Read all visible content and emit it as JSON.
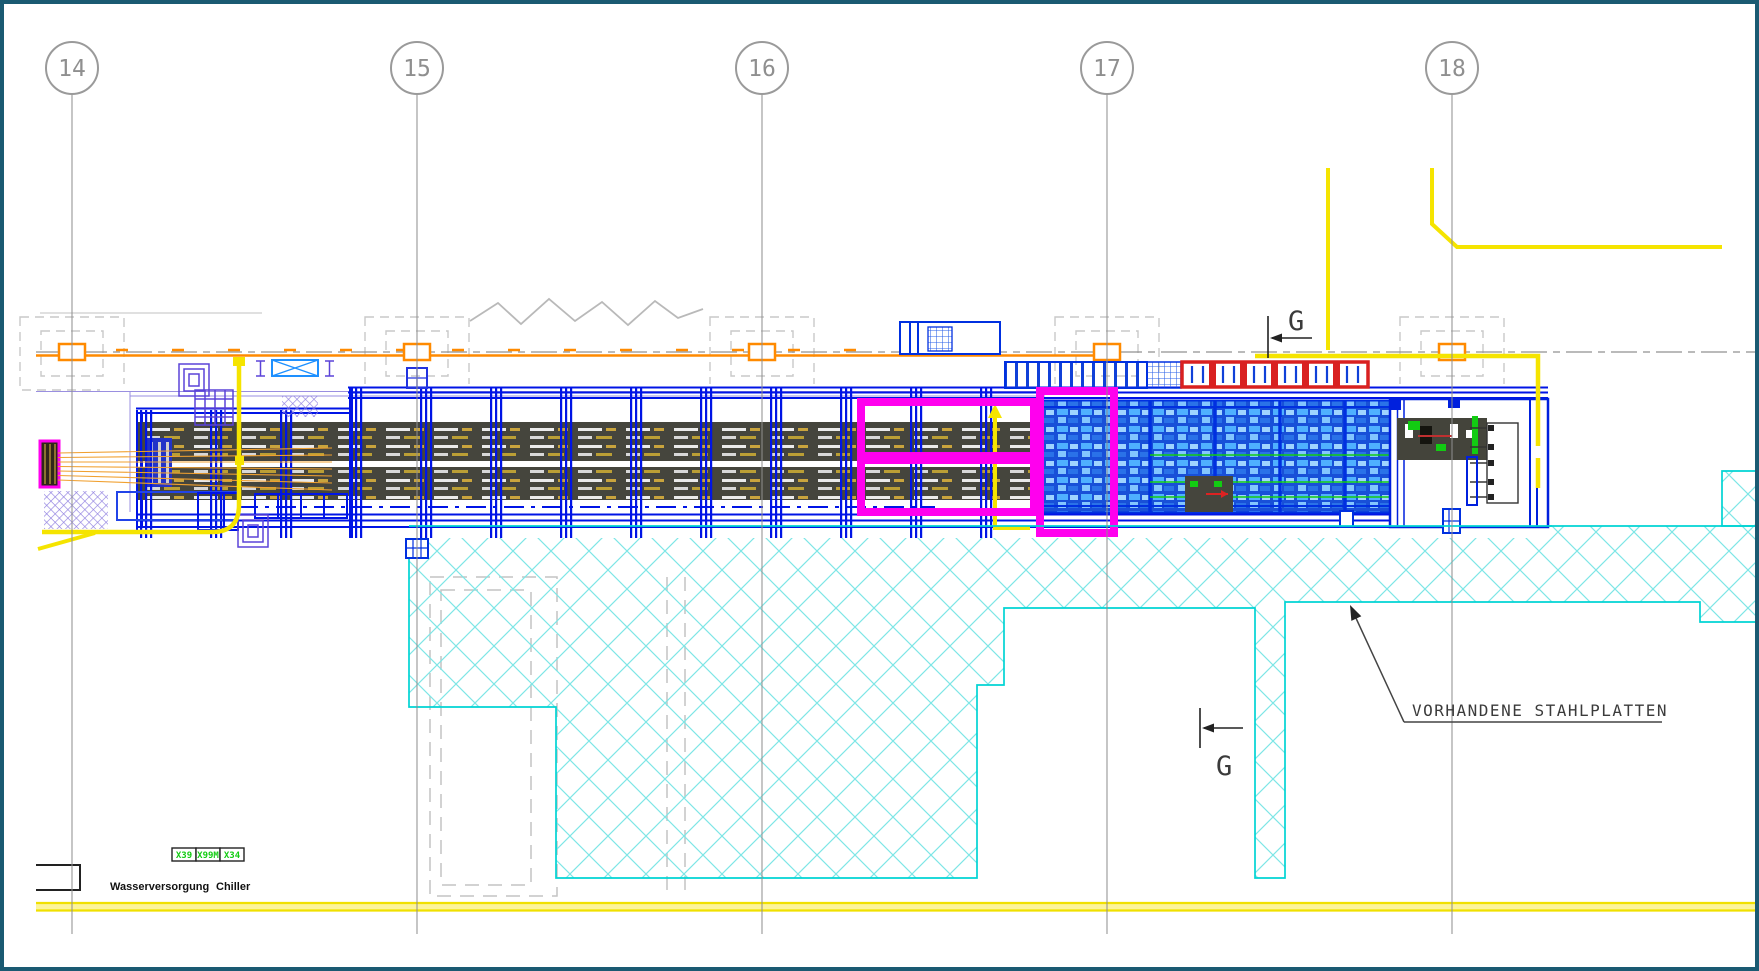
{
  "drawing": {
    "kind": "floor-plan section between axes 14-18",
    "grid": {
      "labels": [
        "14",
        "15",
        "16",
        "17",
        "18"
      ]
    },
    "section_markers": {
      "top": "G",
      "bottom": "G"
    },
    "annotations": {
      "steel_plates": "VORHANDENE STAHLPLATTEN"
    },
    "legend": {
      "water_supply": "Wasserversorgung",
      "chiller": "Chiller",
      "connector_boxes": [
        "X39",
        "X99M",
        "X34"
      ]
    },
    "colors": {
      "frame": "#1a5a72",
      "grid_line": "#8f8f8f",
      "orange": "#ff8a00",
      "blue": "#0014e6",
      "light_blue": "#4fb0ff",
      "magenta": "#ff00ee",
      "cyan": "#00d4d4",
      "cyan_hatch": "#7ee6e6",
      "red": "#d92020",
      "green": "#12cc12",
      "yellow": "#f5e400",
      "purple": "#5b43d8",
      "band": "#45453d",
      "text": "#3b3b3b"
    }
  }
}
